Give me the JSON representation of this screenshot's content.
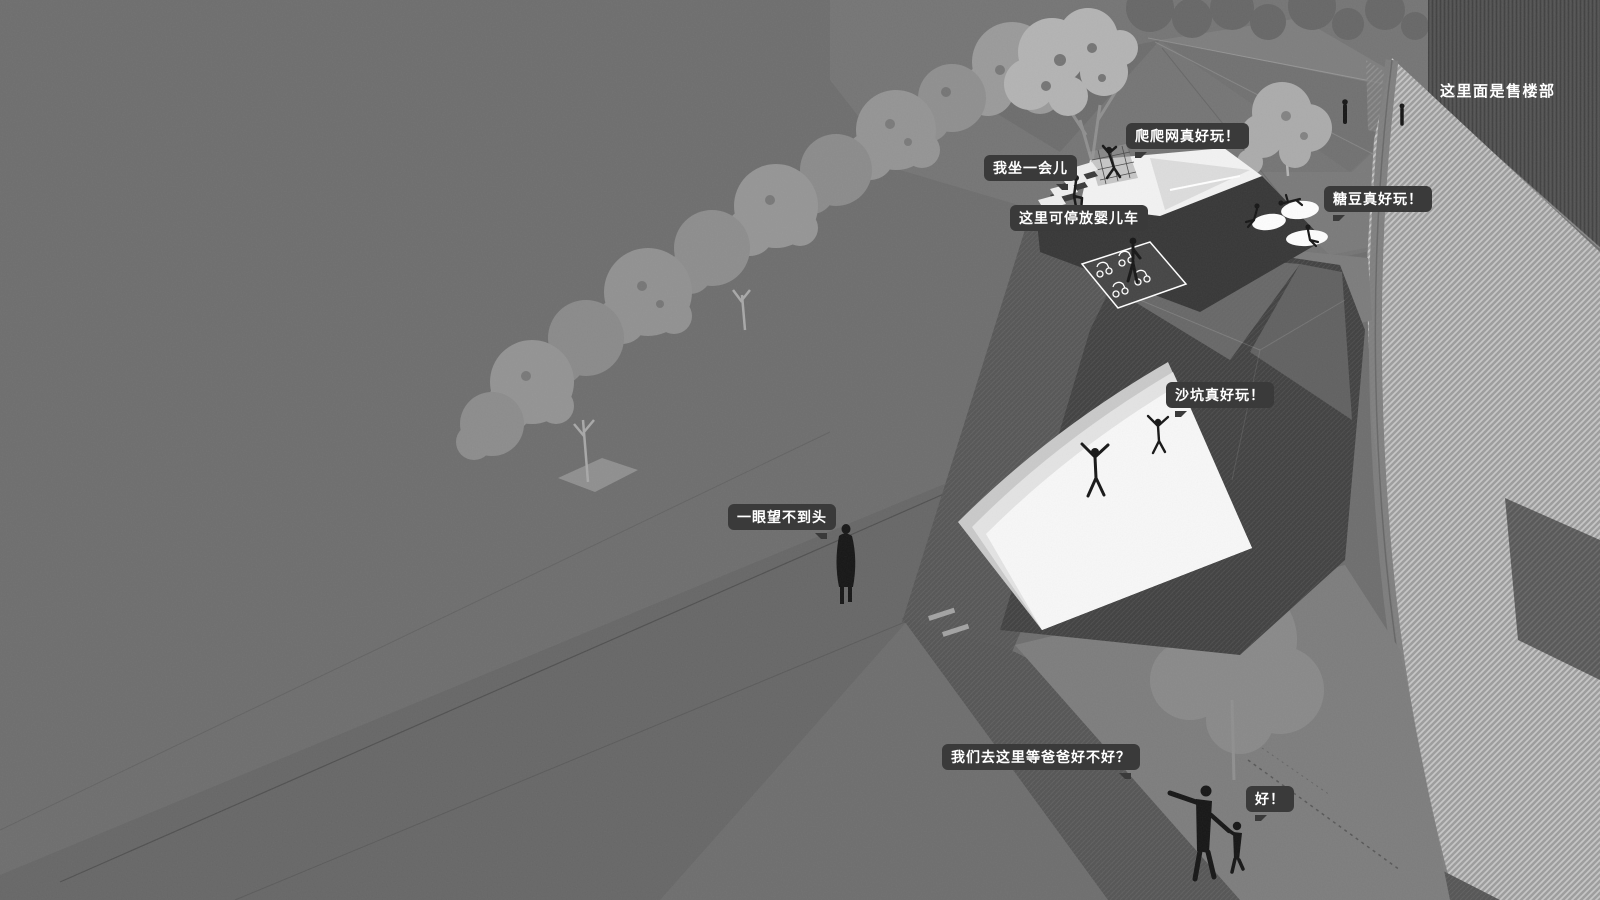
{
  "labels": {
    "sales_office": "这里面是售楼部",
    "climbing_net": "爬爬网真好玩！",
    "sit_a_while": "我坐一会儿",
    "stroller_parking": "这里可停放婴儿车",
    "candy_beans": "糖豆真好玩！",
    "sand_pit": "沙坑真好玩！",
    "endless_view": "一眼望不到头",
    "wait_for_dad": "我们去这里等爸爸好不好？",
    "ok_reply": "好！"
  },
  "colors": {
    "background": "#6e6e6e",
    "lawn_shade": "#676767",
    "path_dark": "#545454",
    "stroller_zone_dark": "#454545",
    "playground_dark": "#404040",
    "structure_face": "#373737",
    "structure_top_white": "#f2f2f2",
    "sand_white": "#f7f7f7",
    "tree_gray": "#919191",
    "tree_light": "#b3b3b3",
    "hatch_base": "#9d9d9d",
    "hatch_stripe": "#c6c6c6",
    "building_dark": "#4e4e4e",
    "bubble_background": "#3a3a3a",
    "bubble_text": "#ffffff",
    "figure_black": "#161616"
  }
}
